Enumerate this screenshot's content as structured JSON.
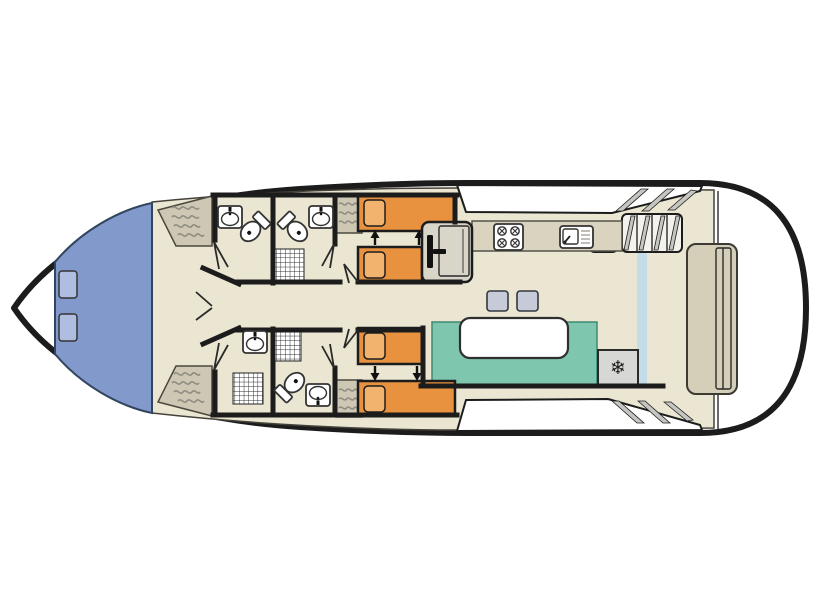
{
  "colors": {
    "hull_outline": "#1c1c1c",
    "wall": "#1c1c1c",
    "floor": "#eae6d1",
    "bow_deck": "#8299cb",
    "bow_hatch": "#aebde0",
    "wardrobe": "#cdc7b4",
    "hanger": "#8f8c80",
    "bed": "#e8923f",
    "pillow": "#f2b36e",
    "bench": "#7fc6ae",
    "stool": "#c7cbd8",
    "counter": "#d9d3bf",
    "fridge": "#d7d7d5",
    "glass_door": "#bcd9ec",
    "aft_bench": "#d5cfba",
    "step_shade": "#c5c5c1"
  },
  "icons": {
    "fridge_snowflake": "❄"
  },
  "plan": {
    "type": "boat-deck-floorplan",
    "bow_deck": {
      "hatches": 2
    },
    "cabins": [
      {
        "name": "forward-top-cabin",
        "beds": 2,
        "sliding_bed_arrows": 2
      },
      {
        "name": "forward-bottom-cabin",
        "beds": 2,
        "sliding_bed_arrows": 2
      }
    ],
    "bathrooms": [
      {
        "name": "top-left-bathroom",
        "fixtures": [
          "sink",
          "toilet"
        ]
      },
      {
        "name": "top-right-bathroom",
        "fixtures": [
          "toilet",
          "sink",
          "shower"
        ]
      },
      {
        "name": "bottom-left-bathroom",
        "fixtures": [
          "sink",
          "shower"
        ]
      },
      {
        "name": "bottom-right-bathroom",
        "fixtures": [
          "shower",
          "toilet",
          "sink"
        ]
      }
    ],
    "wardrobes": 4,
    "galley": {
      "appliances": [
        "stove-4-burner",
        "sink-with-drainer",
        "locker",
        "fridge"
      ]
    },
    "helm": {
      "steering_wheel": 1,
      "seat": 1
    },
    "salon": {
      "bench": 1,
      "table": 1,
      "stools": 2,
      "sliding_glass_door": 1
    },
    "aft": {
      "sun_bench": 1,
      "interior_stairs": 1,
      "exterior_steps_top": 3,
      "exterior_steps_bottom": 3
    }
  }
}
